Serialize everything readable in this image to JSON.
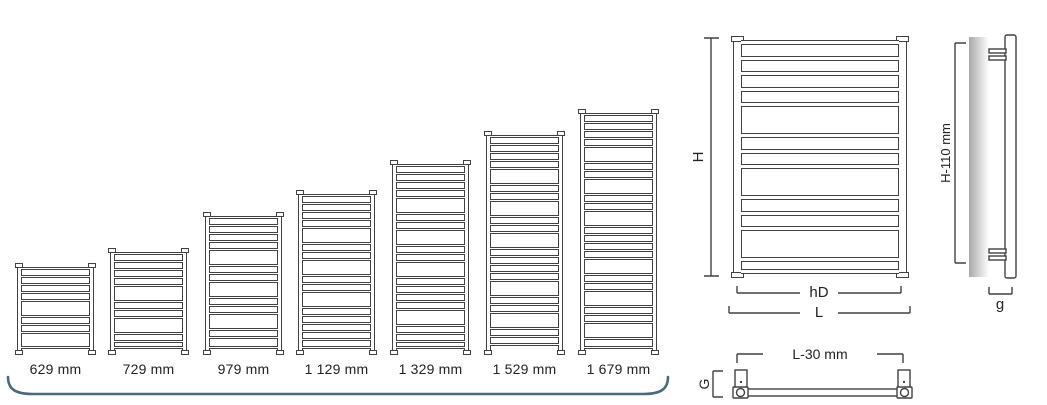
{
  "colors": {
    "line": "#414141",
    "text": "#222222",
    "brace_accent": "#486b79",
    "wall_gradient_dark": "#a9a9a9",
    "wall_gradient_light": "#ffffff"
  },
  "size_chart": {
    "items": [
      {
        "label": "629 mm",
        "height_mm": 629
      },
      {
        "label": "729 mm",
        "height_mm": 729
      },
      {
        "label": "979 mm",
        "height_mm": 979
      },
      {
        "label": "1 129 mm",
        "height_mm": 1129
      },
      {
        "label": "1 329 mm",
        "height_mm": 1329
      },
      {
        "label": "1 529 mm",
        "height_mm": 1529
      },
      {
        "label": "1 679 mm",
        "height_mm": 1679
      }
    ]
  },
  "dimensions": {
    "front": {
      "height_label": "H",
      "rail_span_label": "hD",
      "total_width_label": "L"
    },
    "side": {
      "mount_height_label": "H-110 mm",
      "wall_distance_label": "g"
    },
    "top": {
      "mount_span_label": "L-30 mm",
      "depth_label": "G"
    }
  }
}
